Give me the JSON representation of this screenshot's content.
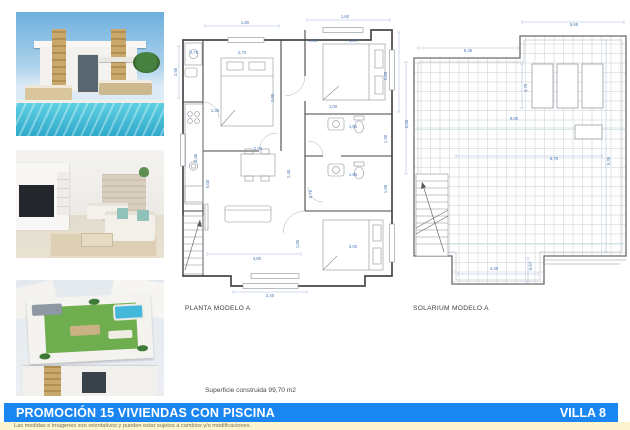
{
  "colors": {
    "banner_blue": "#1a86f2",
    "disclaimer_bg": "#fcf5d0",
    "dimension_text": "#4a7ab5",
    "wall": "#474747",
    "tile_line": "#d6dbe0",
    "pool_blue": "#2fa9cb",
    "lawn_green": "#6fae4e"
  },
  "plans": {
    "planta": {
      "label": "PLANTA MODELO A",
      "dims": [
        {
          "t": "1,80",
          "x": 72,
          "y": 18
        },
        {
          "t": "1,60",
          "x": 172,
          "y": 12
        },
        {
          "t": "2,50",
          "x": 4,
          "y": 66,
          "v": 1
        },
        {
          "t": "0,78",
          "x": 21,
          "y": 48
        },
        {
          "t": "2,70",
          "x": 69,
          "y": 48
        },
        {
          "t": "2,00",
          "x": 101,
          "y": 92,
          "v": 1
        },
        {
          "t": "0,65",
          "x": 140,
          "y": 36
        },
        {
          "t": "3,00",
          "x": 180,
          "y": 36
        },
        {
          "t": "1,00",
          "x": 160,
          "y": 102
        },
        {
          "t": "2,00",
          "x": 214,
          "y": 70,
          "v": 1
        },
        {
          "t": "1,35",
          "x": 42,
          "y": 106
        },
        {
          "t": "0,60",
          "x": 24,
          "y": 152,
          "v": 1
        },
        {
          "t": "1,50",
          "x": 180,
          "y": 122
        },
        {
          "t": "1,90",
          "x": 214,
          "y": 133,
          "v": 1
        },
        {
          "t": "1,60",
          "x": 180,
          "y": 170
        },
        {
          "t": "1,90",
          "x": 214,
          "y": 183,
          "v": 1
        },
        {
          "t": "0,75",
          "x": 139,
          "y": 188,
          "v": 1
        },
        {
          "t": "2,05",
          "x": 85,
          "y": 144
        },
        {
          "t": "1,40",
          "x": 117,
          "y": 168,
          "v": 1
        },
        {
          "t": "5,00",
          "x": 36,
          "y": 178,
          "v": 1
        },
        {
          "t": "3,00",
          "x": 180,
          "y": 242
        },
        {
          "t": "1,05",
          "x": 126,
          "y": 238,
          "v": 1
        },
        {
          "t": "3,80",
          "x": 84,
          "y": 254
        },
        {
          "t": "2,40",
          "x": 97,
          "y": 291
        }
      ]
    },
    "solarium": {
      "label": "SOLARIUM MODELO A",
      "dims": [
        {
          "t": "5,65",
          "x": 172,
          "y": 20
        },
        {
          "t": "5,45",
          "x": 66,
          "y": 46
        },
        {
          "t": "4,75",
          "x": 125,
          "y": 82,
          "v": 1
        },
        {
          "t": "5,00",
          "x": 6,
          "y": 118,
          "v": 1
        },
        {
          "t": "9,00",
          "x": 112,
          "y": 114
        },
        {
          "t": "5,70",
          "x": 152,
          "y": 154
        },
        {
          "t": "5,35",
          "x": 208,
          "y": 155,
          "v": 1
        },
        {
          "t": "4,30",
          "x": 92,
          "y": 264
        },
        {
          "t": "0,97",
          "x": 130,
          "y": 260,
          "v": 1
        }
      ]
    }
  },
  "footer": {
    "superficie": "Superficie construida 99,70 m2",
    "banner_title": "PROMOCIÓN 15 VIVIENDAS CON PISCINA",
    "villa": "VILLA 8",
    "disclaimer": "Las medidas e imagenes son orientativos y pueden estar sujetos a cambios y/o modificaciones."
  }
}
